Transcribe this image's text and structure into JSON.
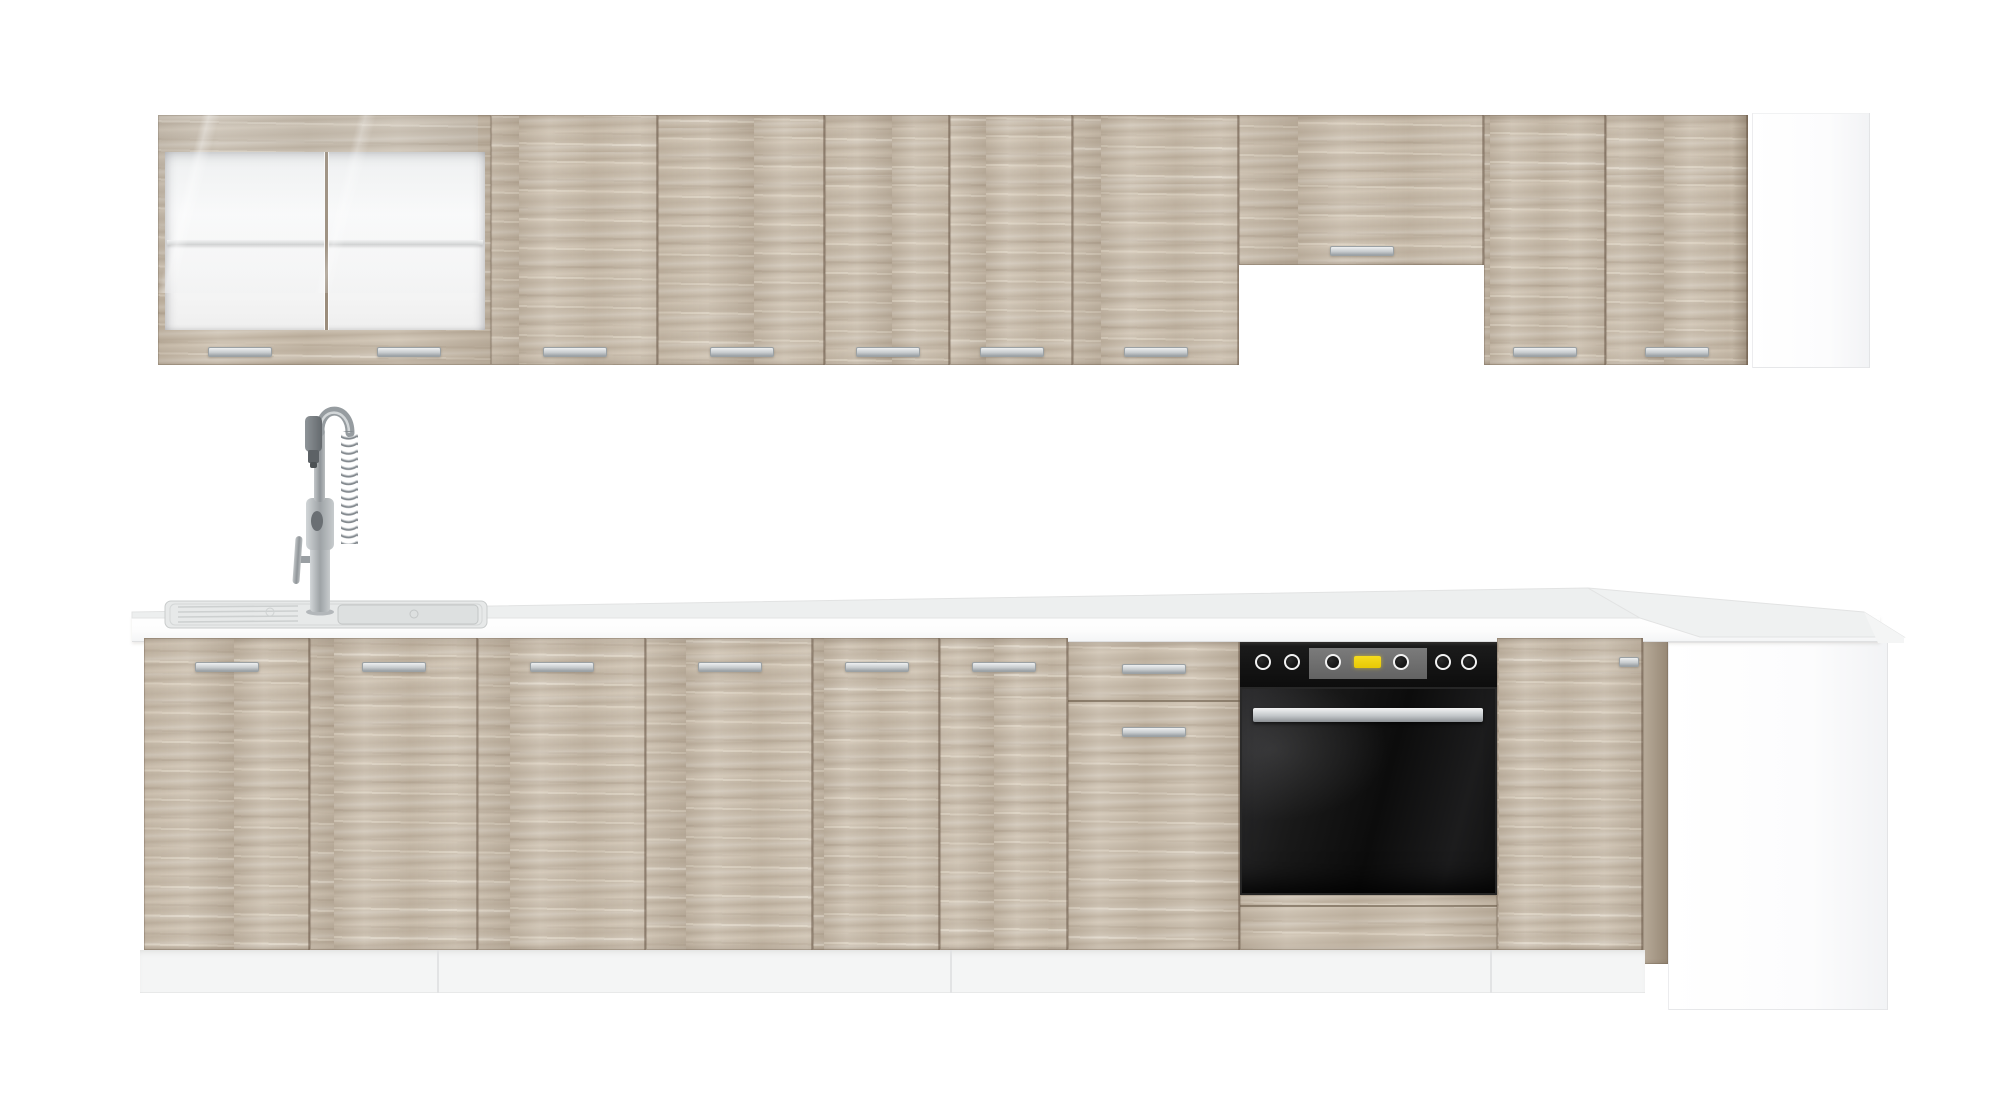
{
  "meta": {
    "type": "product-photo",
    "subject": "Modular kitchen furniture set in light sonoma oak with white worktop",
    "visible_text": "none"
  },
  "colors": {
    "background": "#ffffff",
    "wood_oak": "#c8bcab",
    "wood_gap_line": "#8a7b69",
    "handle_silver": "#c9cdcf",
    "worktop_white": "#fdfdfd",
    "worktop_surface": "#edefef",
    "plinth_white": "#f4f5f5",
    "side_panel_white": "#fbfbfc",
    "glass_interior_white": "#f8f8f8",
    "oven_black": "#141414",
    "oven_panel_gray": "#6f6f6f",
    "oven_display_yellow": "#f2d411",
    "faucet_steel": "#9ba0a4",
    "sink_steel": "#e2e4e4"
  },
  "inventory": {
    "upper_row": {
      "label": "wall cabinets",
      "glass_doors": 2,
      "plain_doors": 7,
      "hood_gap_cabinet": 1,
      "white_end_panel": 1,
      "handle_count": 10
    },
    "lower_row": {
      "label": "base cabinets with worktop",
      "doors": 7,
      "drawer_fronts": 1,
      "built_in_oven": 1,
      "oven_knobs": 6,
      "sink": 1,
      "pull_down_faucet": 1,
      "corner_unit": 1,
      "white_end_panel": 1
    }
  },
  "geometry": {
    "upper_row": {
      "top": 115,
      "height": 250,
      "handle_y": 347,
      "handle_w": 64,
      "glass_cabinet": {
        "x": 158,
        "w": 333,
        "interior": [
          165,
          152,
          320,
          178
        ],
        "shelf_y": 240,
        "mullion_x": 325,
        "handles": [
          [
            208,
            347
          ],
          [
            377,
            347
          ]
        ]
      },
      "plain_doors": [
        {
          "x": 491,
          "w": 167
        },
        {
          "x": 658,
          "w": 167
        },
        {
          "x": 825,
          "w": 125
        },
        {
          "x": 950,
          "w": 123
        },
        {
          "x": 1073,
          "w": 166
        },
        {
          "x": 1239,
          "w": 245,
          "h": 150,
          "hy": 246,
          "name": "hood-gap-cabinet-flap"
        },
        {
          "x": 1484,
          "w": 122
        },
        {
          "x": 1606,
          "w": 142,
          "edge": true
        }
      ],
      "white_panel": {
        "x": 1752,
        "y": 113,
        "w": 118,
        "h": 255
      }
    },
    "worktop": {
      "band": {
        "x": 132,
        "y": 616,
        "w": 1748,
        "h": 26
      },
      "surface_poly": "132,612 1588,588 1640,618 132,618",
      "corner_poly": "1588,588 1864,612 1904,637 1700,637 1640,618",
      "corner_cap_poly": "1864,612 1904,637 1904,643 1878,643"
    },
    "lower_row": {
      "top": 638,
      "height": 312,
      "handle_y": 662,
      "handle_w": 64,
      "doors": [
        {
          "x": 144,
          "w": 166
        },
        {
          "x": 310,
          "w": 168
        },
        {
          "x": 478,
          "w": 168
        },
        {
          "x": 646,
          "w": 167
        },
        {
          "x": 813,
          "w": 127
        },
        {
          "x": 940,
          "w": 128
        },
        {
          "x": 1497,
          "w": 146,
          "hx": 1619,
          "hy": 657,
          "hw": 20,
          "name": "corner-base-door"
        }
      ],
      "drawer_unit": {
        "x": 1068,
        "w": 172,
        "split_y": 700,
        "handle1_y": 664,
        "handle2_y": 727
      },
      "corner_edge": {
        "x": 1643,
        "w": 25,
        "y": 638,
        "h": 326
      },
      "white_panel": {
        "x": 1668,
        "y": 642,
        "w": 220,
        "h": 368
      },
      "plinth": {
        "x": 140,
        "y": 950,
        "w": 1505,
        "h": 43,
        "joints_x": [
          437,
          950,
          1490
        ]
      }
    },
    "oven": {
      "x": 1240,
      "y": 640,
      "w": 257,
      "panel_h": 47,
      "knob_cx": [
        1263,
        1292,
        1333,
        1401,
        1443,
        1469
      ],
      "knob_cy": 662,
      "knob_r": 8,
      "gray_panel": [
        1309,
        648,
        118,
        31
      ],
      "display": [
        1354,
        656,
        27,
        12
      ],
      "door_y": 687,
      "door_h": 208,
      "handle": [
        1253,
        708,
        230,
        14
      ],
      "base_wood_y": 895,
      "base_wood_h": 55,
      "base_groove_y": 905
    },
    "sink": {
      "x": 165,
      "y": 601,
      "w": 322,
      "h": 27,
      "drainer_x": [
        178,
        298
      ],
      "basin": [
        338,
        605,
        140,
        19
      ]
    },
    "faucet": {
      "base_x": 320,
      "base_y": 612,
      "top_y": 414
    }
  }
}
